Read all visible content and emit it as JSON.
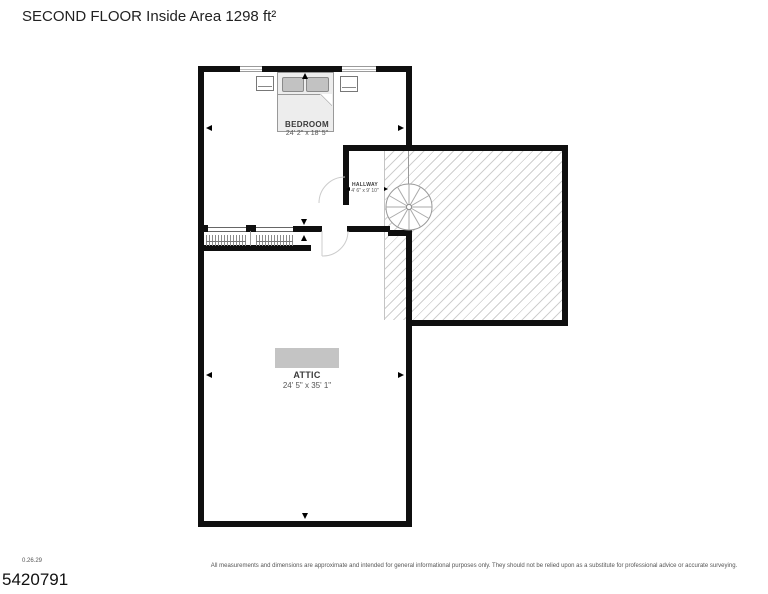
{
  "title": "SECOND FLOOR Inside Area 1298 ft²",
  "rooms": {
    "bedroom": {
      "name": "BEDROOM",
      "dims": "24' 2\" x 18' 5\""
    },
    "hallway": {
      "name": "HALLWAY",
      "dims": "4' 6\" x 9' 10\""
    },
    "attic": {
      "name": "ATTIC",
      "dims": "24' 5\" x 35' 1\""
    }
  },
  "colors": {
    "wall": "#0f0f0f",
    "hatch_line": "#cfcfcf",
    "furniture_fill": "#ededed",
    "pillow_fill": "#c2c2c2",
    "attic_object_fill": "#c4c4c4"
  },
  "footer": {
    "version": "0.26.29",
    "listing_id": "5420791",
    "disclaimer": "All measurements and dimensions are approximate and intended for general informational purposes only. They should not be relied upon as a substitute for professional advice or accurate surveying."
  }
}
